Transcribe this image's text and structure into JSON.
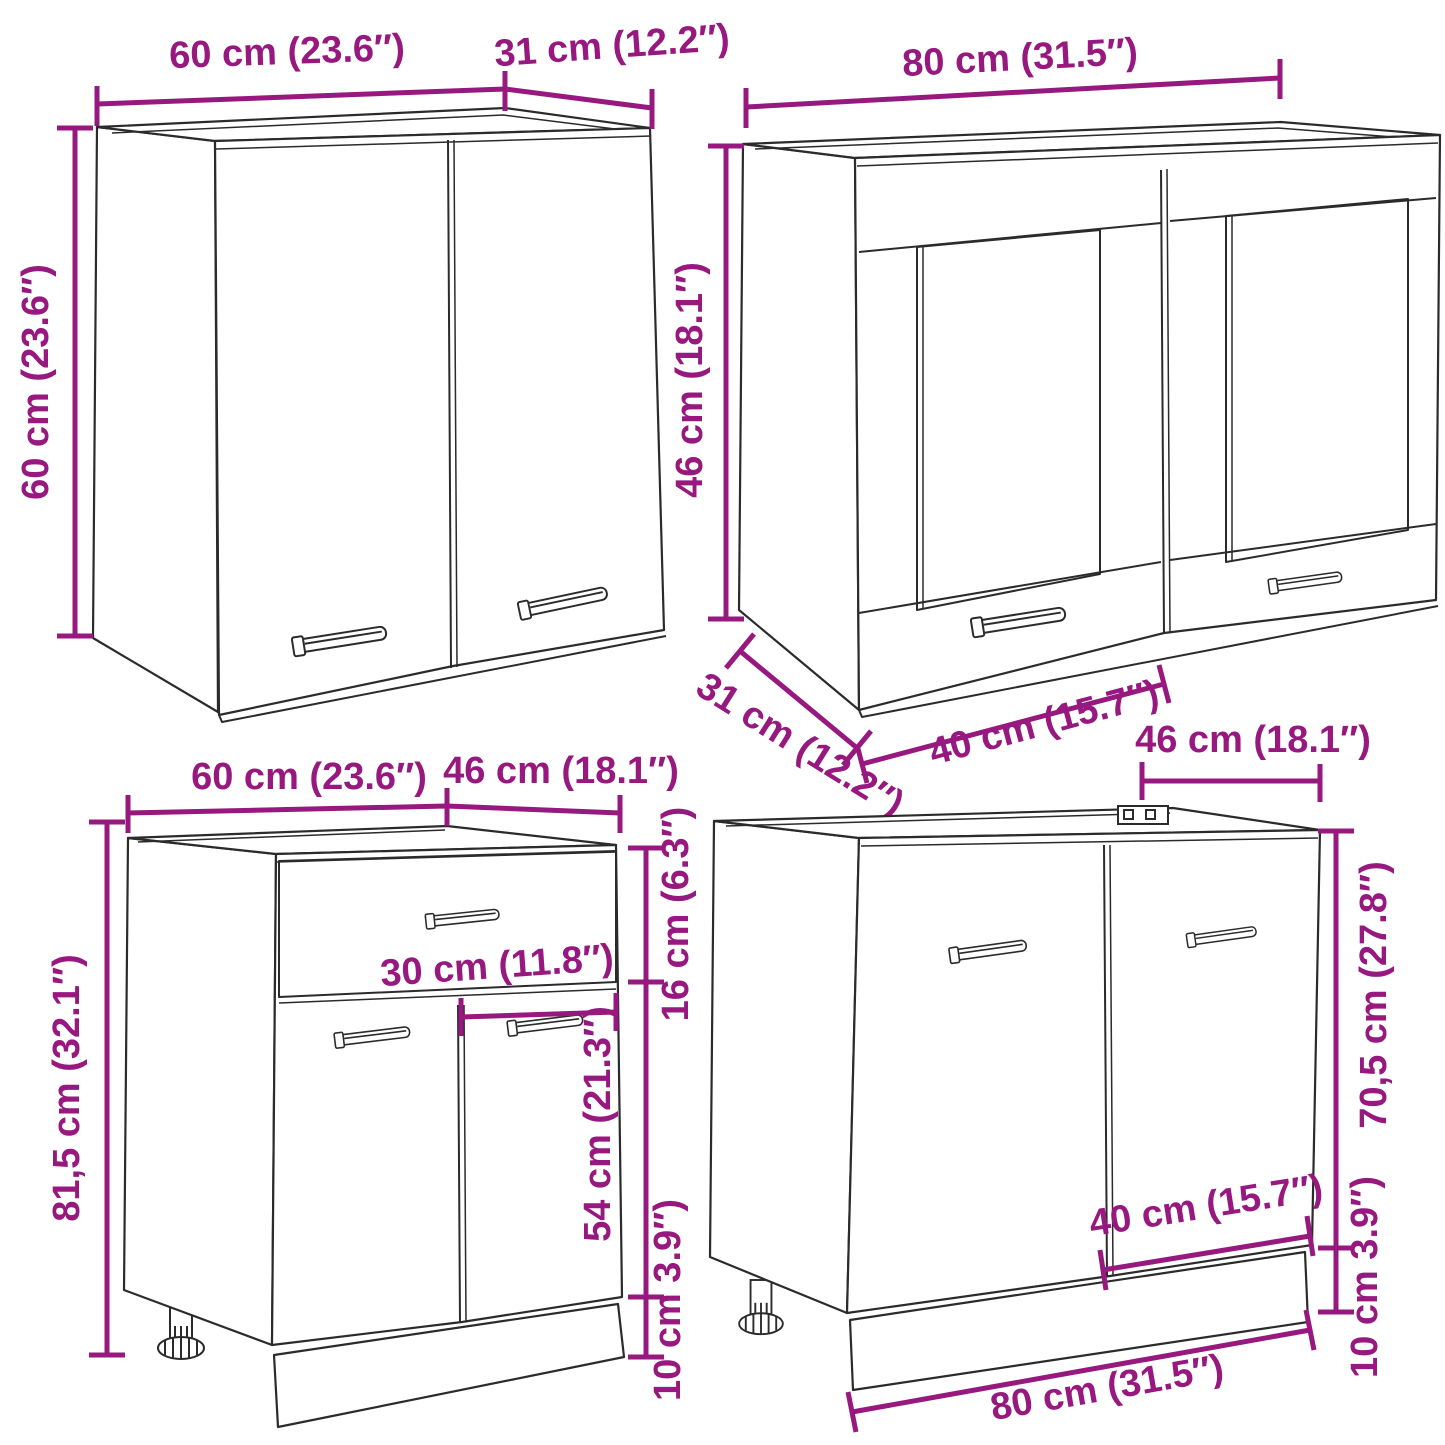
{
  "diagram": {
    "type": "furniture-dimension-diagram",
    "accent_color": "#97187F",
    "line_color": "#2b2b2b",
    "background_color": "#ffffff",
    "cabinets": [
      {
        "id": "wall-cabinet-2-doors",
        "position": "top-left",
        "labels": {
          "width": "60 cm (23.6″)",
          "depth": "31 cm (12.2″)",
          "height": "60 cm (23.6″)"
        }
      },
      {
        "id": "wall-glass-cabinet-2-doors",
        "position": "top-right",
        "labels": {
          "width": "80 cm (31.5″)",
          "height": "46 cm (18.1″)",
          "depth": "31 cm (12.2″)",
          "door_width": "40 cm (15.7″)"
        }
      },
      {
        "id": "base-cabinet-drawer-2-doors",
        "position": "bottom-left",
        "labels": {
          "width": "60 cm (23.6″)",
          "depth": "46 cm (18.1″)",
          "height": "81,5 cm (32.1″)",
          "drawer_height": "16 cm (6.3″)",
          "door_width": "30 cm (11.8″)",
          "door_height": "54 cm (21.3″)",
          "plinth_height": "10 cm 3.9″)"
        }
      },
      {
        "id": "sink-base-cabinet-2-doors",
        "position": "bottom-right",
        "labels": {
          "depth": "46 cm (18.1″)",
          "height": "70,5 cm (27.8″)",
          "door_width": "40 cm (15.7″)",
          "plinth_height": "10 cm 3.9″)",
          "width": "80 cm (31.5″)"
        }
      }
    ]
  }
}
